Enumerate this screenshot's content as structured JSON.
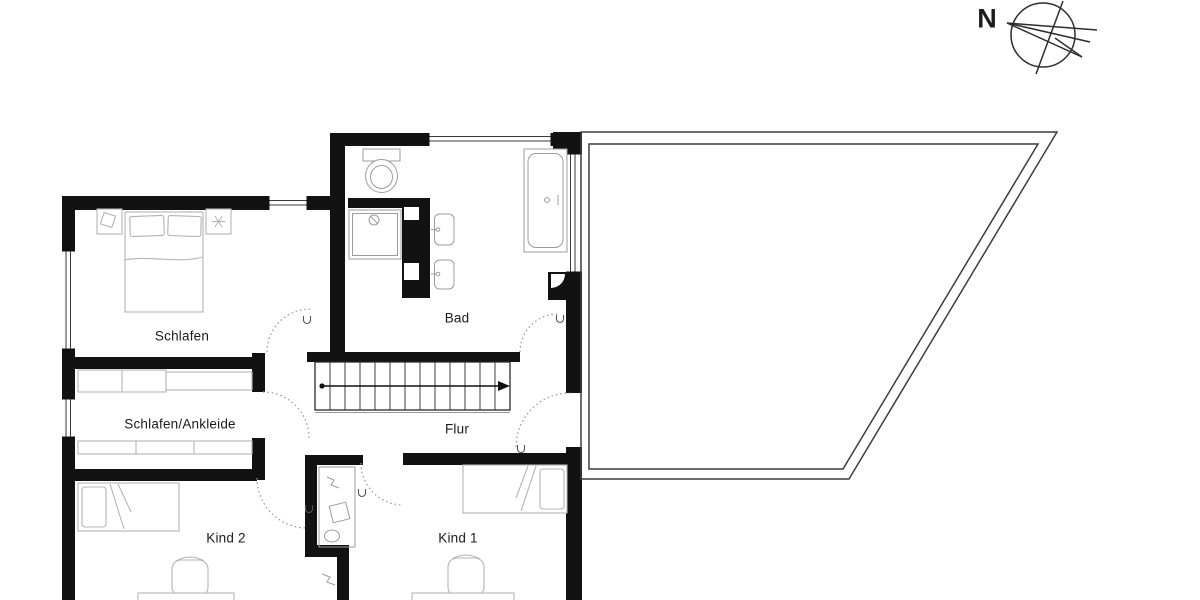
{
  "compass": {
    "label": "N"
  },
  "rooms": [
    {
      "id": "schlafen",
      "label": "Schlafen"
    },
    {
      "id": "bad",
      "label": "Bad"
    },
    {
      "id": "schlafen-ankleide",
      "label": "Schlafen/Ankleide"
    },
    {
      "id": "flur",
      "label": "Flur"
    },
    {
      "id": "kind-2",
      "label": "Kind 2"
    },
    {
      "id": "kind-1",
      "label": "Kind 1"
    }
  ],
  "colors": {
    "background": "#ffffff",
    "walls": "#121212",
    "furniture_outline": "#b4b4b4",
    "fixture_outline": "#9c9c9c",
    "terrace_outline": "#3d3d3d",
    "label_text": "#1c1c1c"
  }
}
